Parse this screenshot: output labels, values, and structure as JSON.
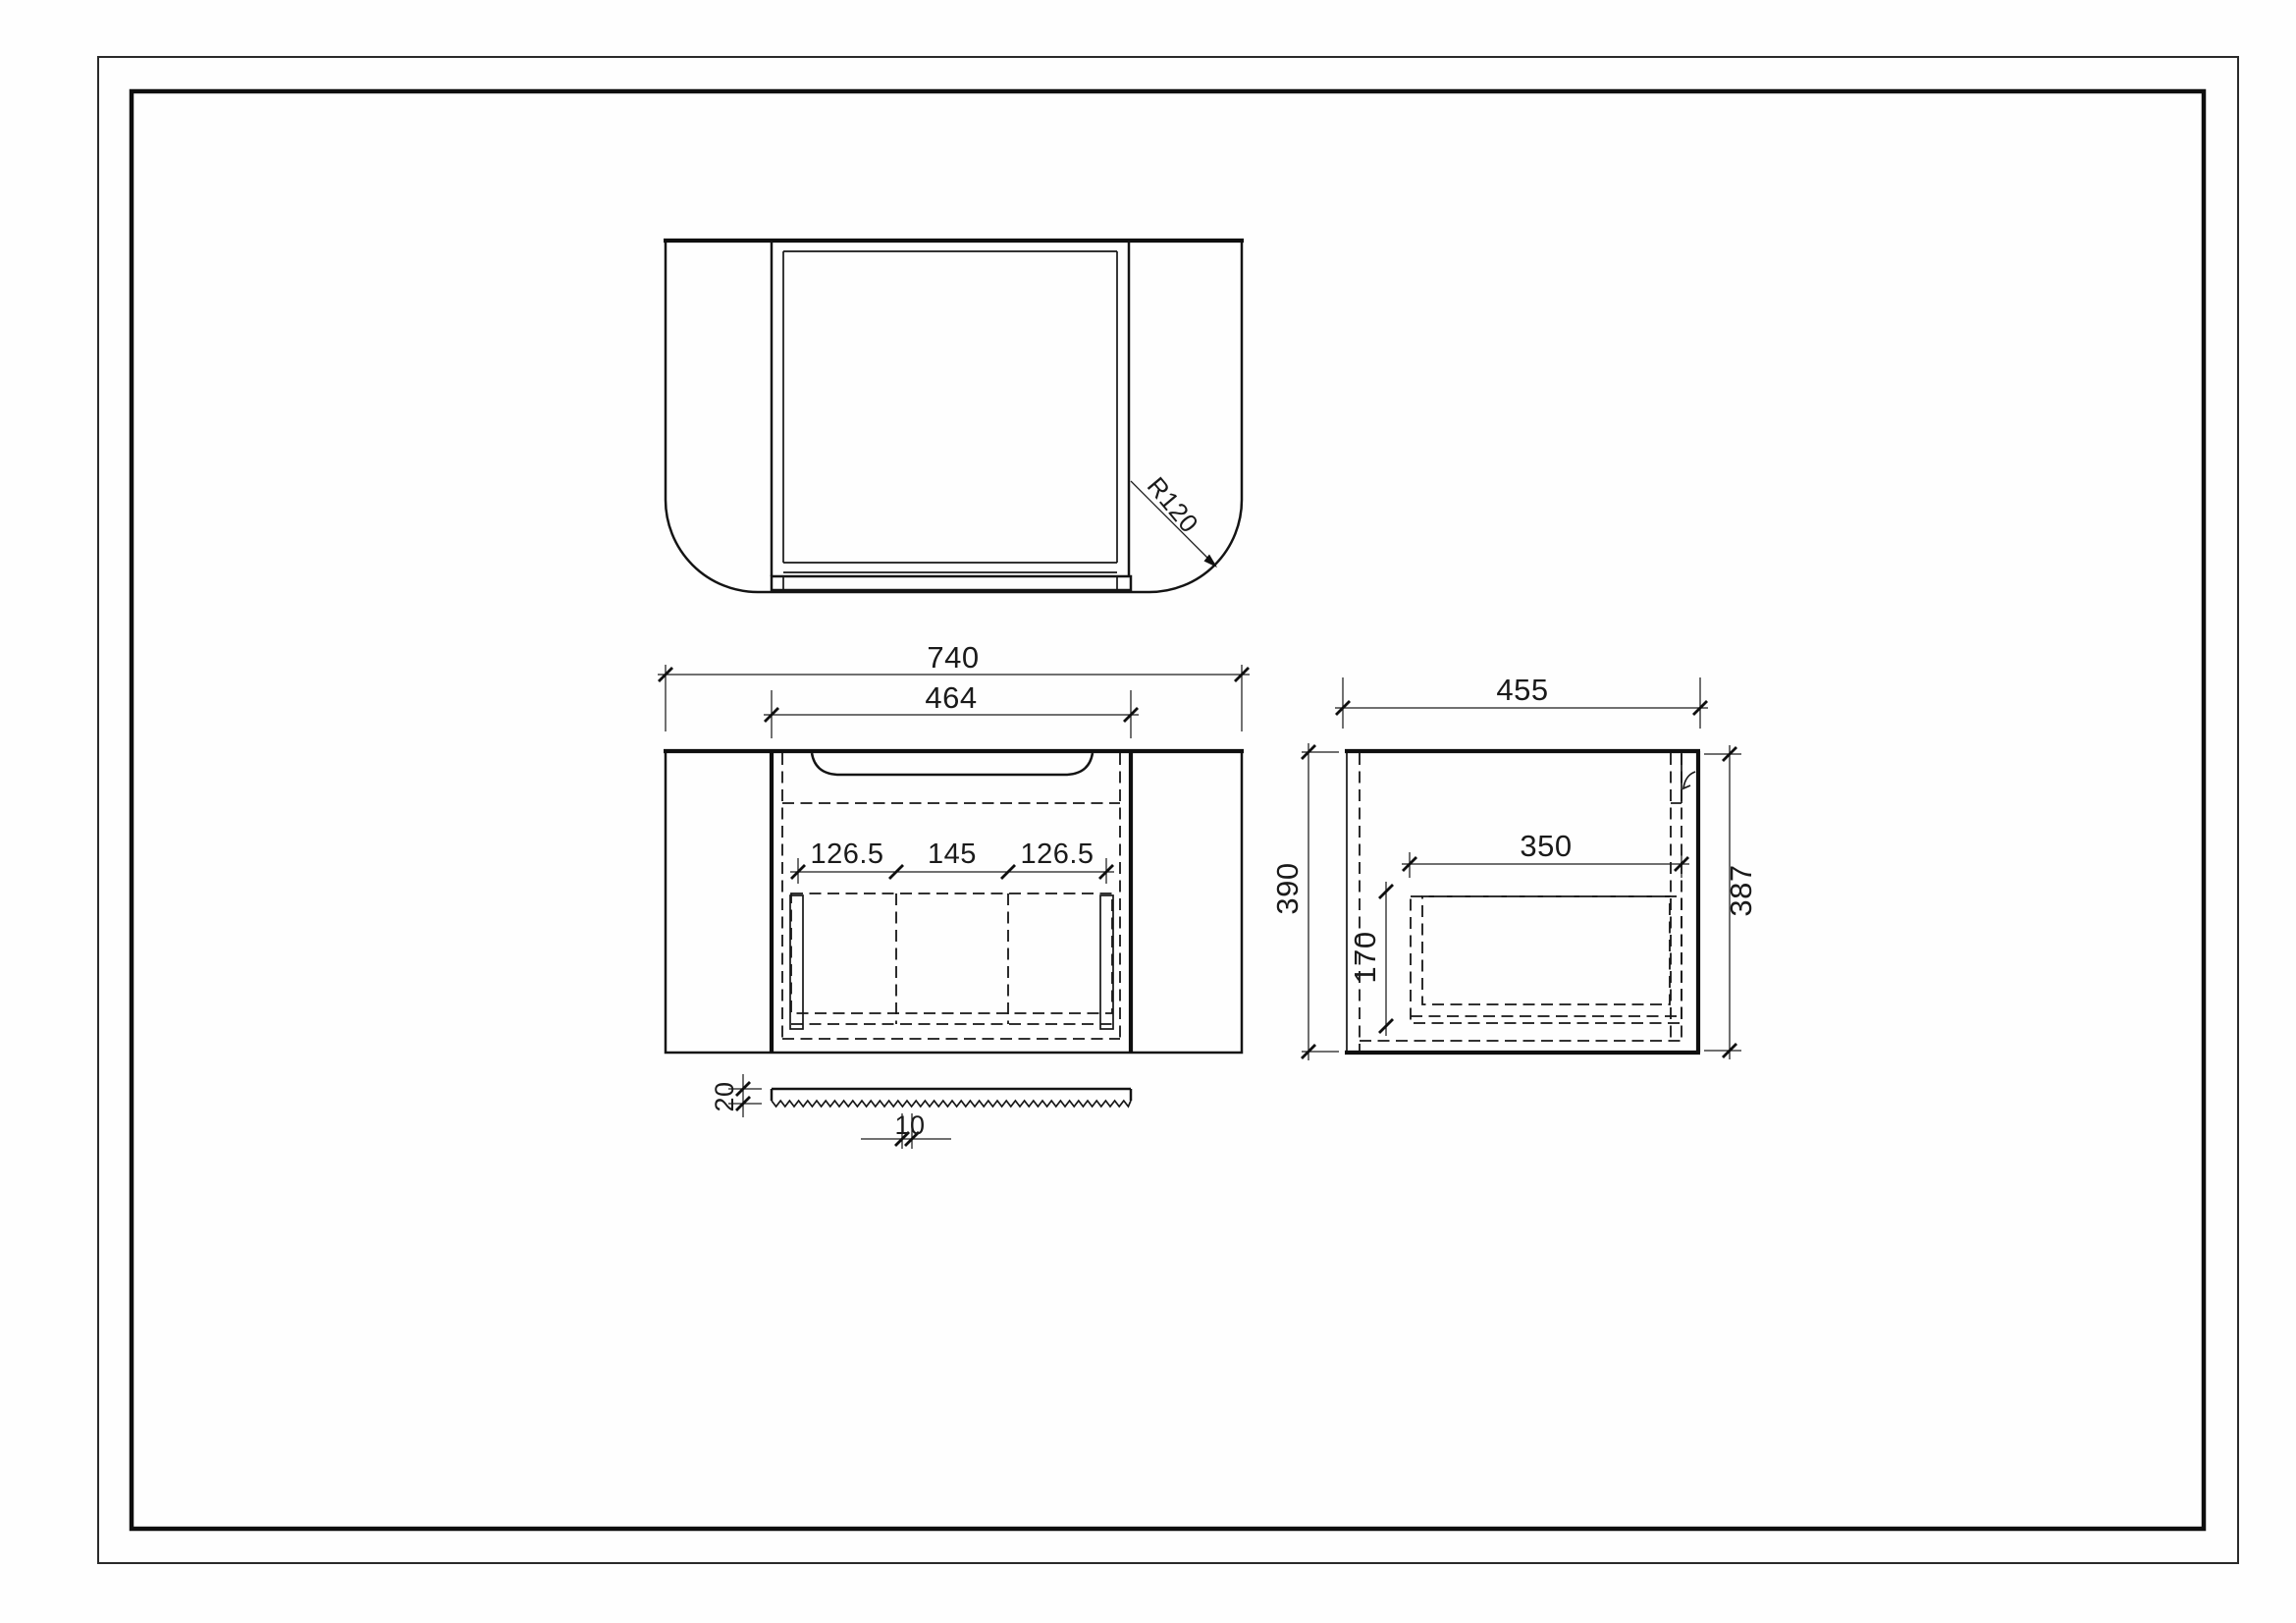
{
  "sheet": {
    "background": "#fefefe",
    "line_color": "#0f0f0f",
    "description": "three-view technical drawing of wall-hung vanity cabinet with countertop"
  },
  "top_view": {
    "radius_label": "R120"
  },
  "front_view": {
    "overall_width": "740",
    "body_width": "464",
    "drawer_left": "126.5",
    "drawer_center": "145",
    "drawer_right": "126.5"
  },
  "side_view": {
    "depth": "455",
    "height_left": "390",
    "height_right": "387",
    "drawer_depth": "350",
    "drawer_height": "170"
  },
  "strip_detail": {
    "thickness": "20",
    "tooth_width": "10"
  }
}
